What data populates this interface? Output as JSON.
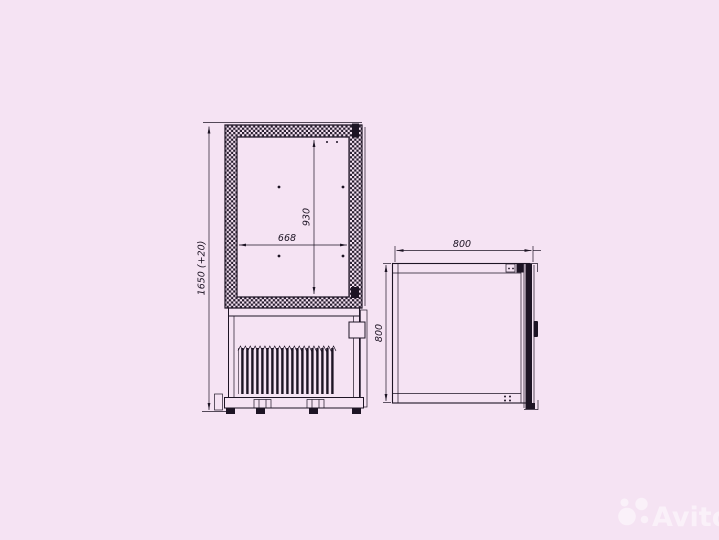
{
  "canvas": {
    "background_color": "#f5e3f3",
    "line_color": "#1d1424"
  },
  "drawing": {
    "front_view": {
      "overall_height": "1650 (+20)",
      "inner_height": "930",
      "inner_width": "668"
    },
    "side_view": {
      "depth": "800",
      "height": "800"
    }
  },
  "watermark": {
    "text": "Avito",
    "color": "#ffffff",
    "icon": "avito-circles-logo"
  }
}
